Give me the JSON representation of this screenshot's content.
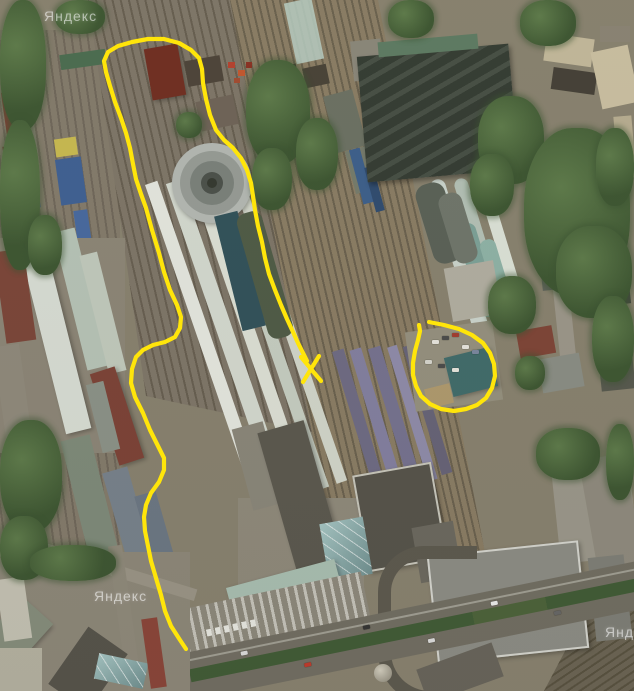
{
  "meta": {
    "view": "satellite imagery of a railway yard and station area",
    "annotation_tool_color": "#ffe50a"
  },
  "watermarks": [
    {
      "text": "Яндекс"
    },
    {
      "text": "Яндекс"
    },
    {
      "text": "Яндекс"
    }
  ],
  "annotations": {
    "color": "#ffe50a",
    "stroke_width": 4.2,
    "route_path": [
      [
        186,
        649
      ],
      [
        180,
        640
      ],
      [
        171,
        626
      ],
      [
        165,
        611
      ],
      [
        161,
        595
      ],
      [
        156,
        578
      ],
      [
        151,
        561
      ],
      [
        148,
        546
      ],
      [
        145,
        531
      ],
      [
        144,
        517
      ],
      [
        146,
        505
      ],
      [
        151,
        493
      ],
      [
        159,
        482
      ],
      [
        164,
        470
      ],
      [
        164,
        458
      ],
      [
        158,
        446
      ],
      [
        150,
        430
      ],
      [
        143,
        413
      ],
      [
        135,
        397
      ],
      [
        131,
        383
      ],
      [
        132,
        369
      ],
      [
        136,
        357
      ],
      [
        143,
        350
      ],
      [
        153,
        345
      ],
      [
        165,
        342
      ],
      [
        175,
        337
      ],
      [
        180,
        328
      ],
      [
        181,
        317
      ],
      [
        177,
        305
      ],
      [
        170,
        290
      ],
      [
        164,
        272
      ],
      [
        159,
        253
      ],
      [
        152,
        230
      ],
      [
        146,
        208
      ],
      [
        141,
        194
      ],
      [
        136,
        179
      ],
      [
        133,
        164
      ],
      [
        130,
        148
      ],
      [
        126,
        133
      ],
      [
        121,
        118
      ],
      [
        115,
        102
      ],
      [
        110,
        86
      ],
      [
        106,
        72
      ],
      [
        104,
        61
      ],
      [
        108,
        52
      ],
      [
        118,
        46
      ],
      [
        132,
        42
      ],
      [
        148,
        39
      ],
      [
        164,
        39
      ],
      [
        179,
        43
      ],
      [
        191,
        50
      ],
      [
        199,
        58
      ],
      [
        202,
        69
      ],
      [
        203,
        83
      ],
      [
        206,
        99
      ],
      [
        210,
        115
      ],
      [
        216,
        130
      ],
      [
        224,
        140
      ],
      [
        233,
        148
      ],
      [
        241,
        158
      ],
      [
        247,
        170
      ],
      [
        251,
        183
      ],
      [
        253,
        196
      ],
      [
        255,
        210
      ],
      [
        258,
        226
      ],
      [
        262,
        242
      ],
      [
        265,
        258
      ],
      [
        269,
        274
      ],
      [
        275,
        290
      ],
      [
        281,
        305
      ],
      [
        287,
        319
      ],
      [
        293,
        332
      ],
      [
        298,
        343
      ],
      [
        303,
        353
      ],
      [
        307,
        361
      ]
    ],
    "x_mark": [
      [
        [
          301,
          357
        ],
        [
          321,
          381
        ]
      ],
      [
        [
          319,
          356
        ],
        [
          303,
          382
        ]
      ]
    ],
    "circle_path": [
      [
        429,
        322
      ],
      [
        444,
        325
      ],
      [
        459,
        329
      ],
      [
        472,
        335
      ],
      [
        483,
        343
      ],
      [
        490,
        353
      ],
      [
        494,
        364
      ],
      [
        495,
        376
      ],
      [
        492,
        388
      ],
      [
        486,
        398
      ],
      [
        477,
        405
      ],
      [
        466,
        409
      ],
      [
        454,
        411
      ],
      [
        441,
        409
      ],
      [
        430,
        404
      ],
      [
        421,
        396
      ],
      [
        416,
        386
      ],
      [
        413,
        375
      ],
      [
        413,
        363
      ],
      [
        415,
        351
      ],
      [
        418,
        340
      ],
      [
        420,
        331
      ],
      [
        419,
        325
      ]
    ]
  }
}
